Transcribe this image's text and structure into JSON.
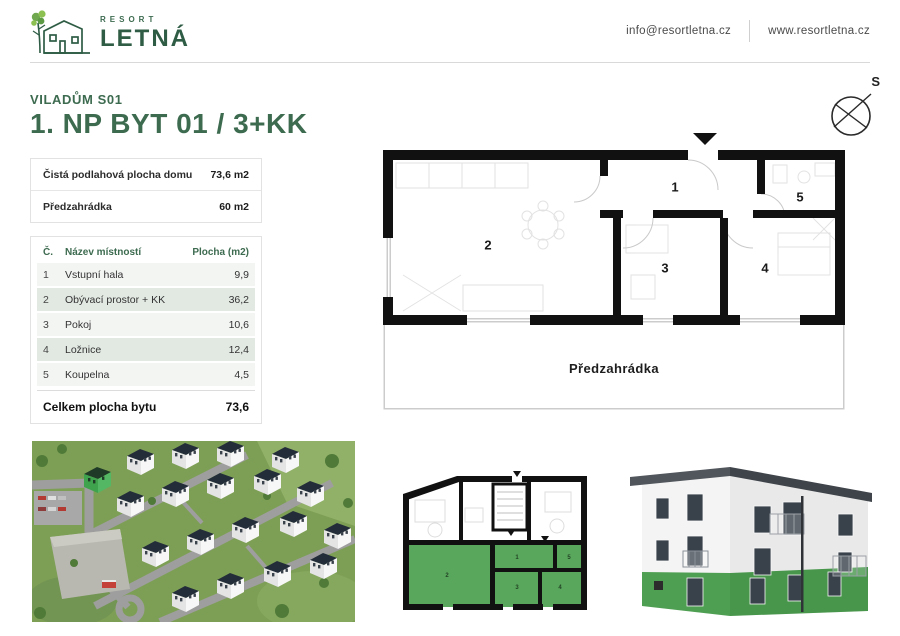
{
  "header": {
    "brand": {
      "name_top": "RESORT",
      "name_main": "LETNÁ"
    },
    "email": "info@resortletna.cz",
    "website": "www.resortletna.cz"
  },
  "page": {
    "subtitle": "VILADŮM S01",
    "title": "1. NP BYT 01 / 3+KK"
  },
  "summary": {
    "rows": [
      {
        "label": "Čistá podlahová plocha domu",
        "value": "73,6 m2"
      },
      {
        "label": "Předzahrádka",
        "value": "60 m2"
      }
    ]
  },
  "rooms": {
    "headers": {
      "num": "Č.",
      "name": "Název místností",
      "area": "Plocha (m2)"
    },
    "rows": [
      {
        "num": "1",
        "name": "Vstupní hala",
        "area": "9,9"
      },
      {
        "num": "2",
        "name": "Obývací prostor + KK",
        "area": "36,2"
      },
      {
        "num": "3",
        "name": "Pokoj",
        "area": "10,6"
      },
      {
        "num": "4",
        "name": "Ložnice",
        "area": "12,4"
      },
      {
        "num": "5",
        "name": "Koupelna",
        "area": "4,5"
      }
    ],
    "total_label": "Celkem plocha bytu",
    "total_value": "73,6"
  },
  "floorplan": {
    "garden_label": "Předzahrádka",
    "compass_label": "S"
  },
  "colors": {
    "accent_green": "#3d6b50",
    "logo_green": "#2e5c44",
    "highlight_green": "#58a75c",
    "wall_black": "#111111",
    "row_light": "#f3f5f3",
    "row_green": "#e2e9e3"
  }
}
